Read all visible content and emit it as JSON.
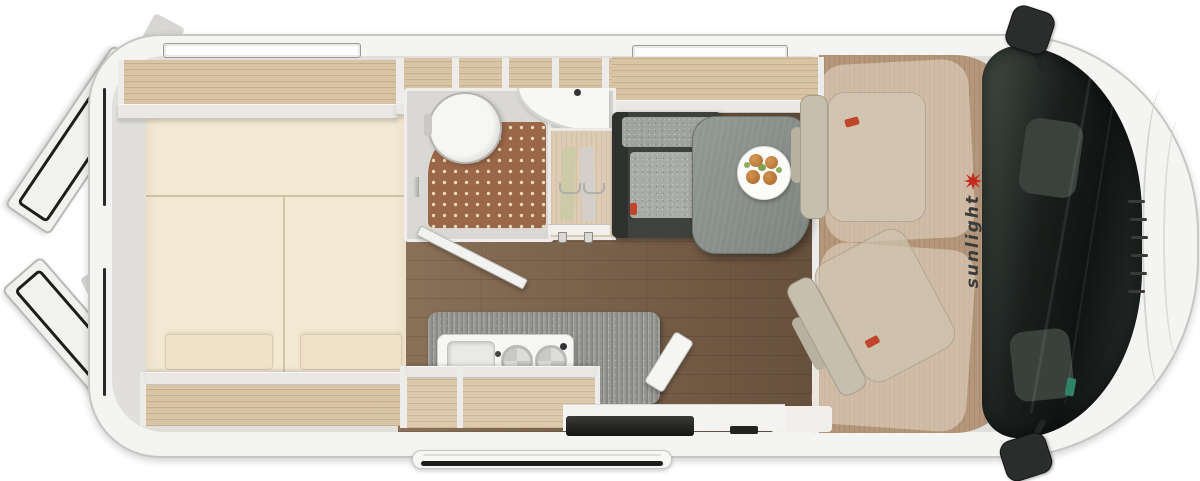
{
  "brand": {
    "name": "sunlight",
    "logo": "red-starburst"
  },
  "vehicle": {
    "view": "top-down floor plan",
    "type": "camper van"
  },
  "colors": {
    "body_shell": "#f4f4f2",
    "interior_wall": "#e0dfdb",
    "wood_cabinet": "#d8c3a3",
    "living_floor_dark": "#6a523d",
    "living_floor_light": "#8a7158",
    "cab_floor": "#b4977a",
    "mattress_cream": "#f3e8d2",
    "counter_gray": "#9c9c98",
    "bench_charcoal": "#3e413e",
    "shower_mat_brown": "#9a6848",
    "windshield_dark": "#1a1f1c",
    "accent_red": "#c3291f"
  },
  "icons": {
    "sunlight_logo": "starburst-sun",
    "mirror_top": "side-mirror",
    "mirror_bottom": "side-mirror"
  }
}
